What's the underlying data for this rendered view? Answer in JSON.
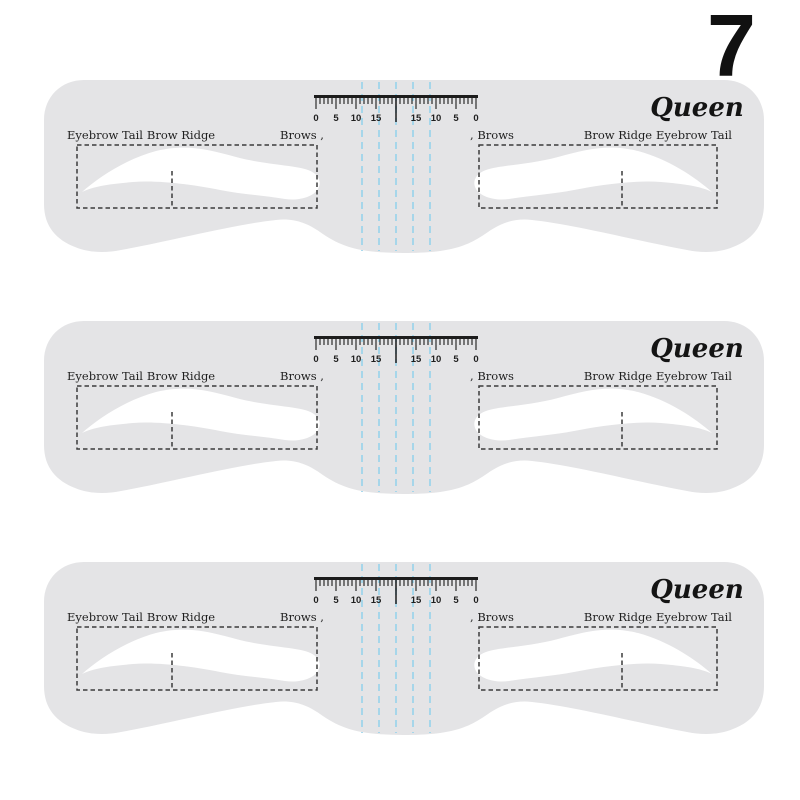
{
  "page": {
    "background": "#ffffff",
    "badge_number": "7"
  },
  "stencil": {
    "brand": "Queen",
    "count": 3,
    "labels": {
      "eyebrow_tail_left": "Eyebrow Tail",
      "brow_ridge_left": "Brow Ridge",
      "brows_left": "Brows ,",
      "brows_right": ", Brows",
      "brow_ridge_right": "Brow Ridge",
      "eyebrow_tail_right": "Eyebrow Tail"
    },
    "ruler": {
      "labels": [
        "0",
        "5",
        "10",
        "15",
        "15",
        "10",
        "5",
        "0"
      ]
    },
    "colors": {
      "body": "#e4e4e6",
      "cutout": "#ffffff",
      "dash": "#3b3b3b",
      "ruler": "#1c1c1c",
      "guide_blue": "#9bd3eb",
      "text": "#1f1f1f",
      "page_bg": "#ffffff"
    }
  }
}
